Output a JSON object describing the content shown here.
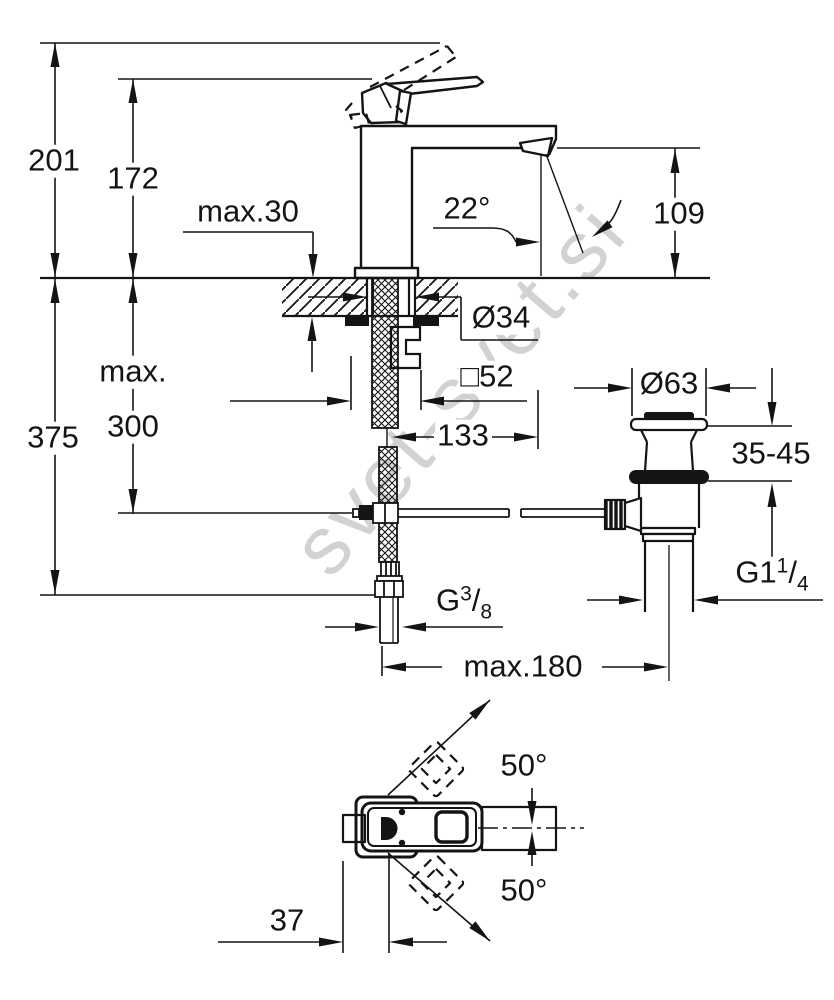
{
  "watermark": {
    "text": "svet-svet.si"
  },
  "dimensions": {
    "d201": "201",
    "d172": "172",
    "max30": "max.30",
    "d375": "375",
    "max_word": "max.",
    "d300": "300",
    "angle_spout": "22°",
    "d109": "109",
    "dia34": "Ø34",
    "square52": "□52",
    "d133": "133",
    "dia63": "Ø63",
    "d35_45": "35-45",
    "thread_hose": {
      "prefix": "G",
      "num": "3",
      "slash": "/",
      "den": "8"
    },
    "max180": "max.180",
    "thread_drain": {
      "prefix": "G1",
      "num": "1",
      "slash": "/",
      "den": "4"
    },
    "angle_handle_top": "50°",
    "angle_handle_bottom": "50°",
    "d37": "37"
  }
}
